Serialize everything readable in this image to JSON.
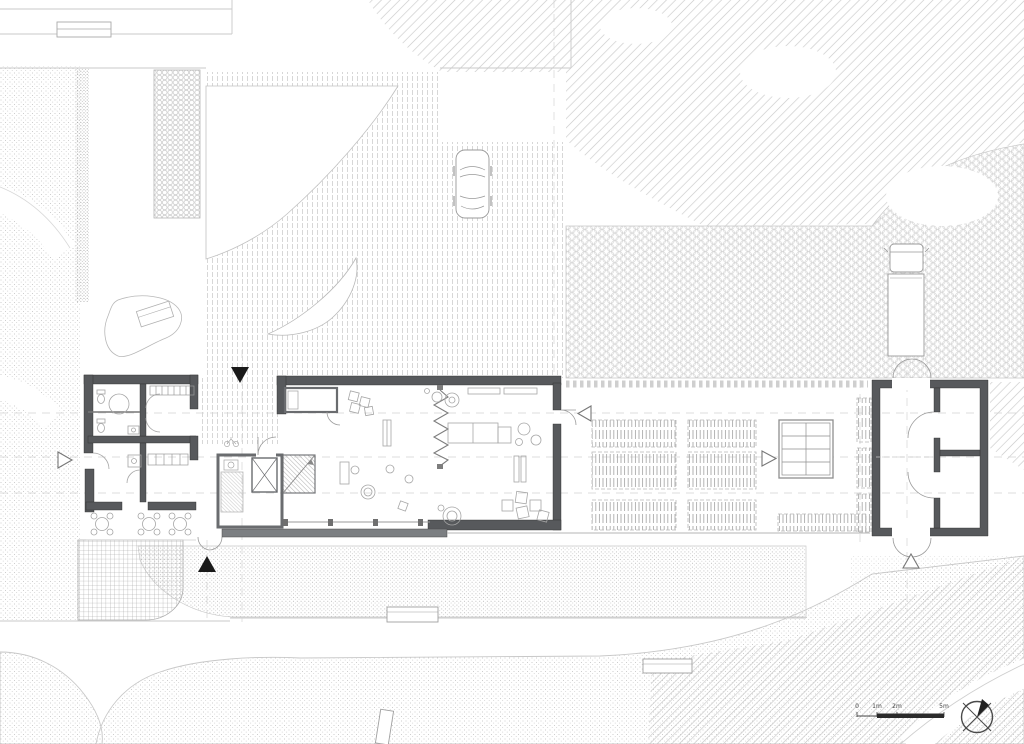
{
  "meta": {
    "drawing_type": "architectural ground-floor site plan",
    "background": "#ffffff"
  },
  "scale_bar": {
    "labels": [
      "0",
      "1m",
      "2m",
      "5m"
    ]
  },
  "symbols": {
    "north_arrow": "crossed-circle north symbol",
    "entrance_marker": "solid black triangle",
    "door_marker": "open white triangle"
  },
  "colors": {
    "ink_light": "#c8c8c8",
    "ink_mid": "#9a9a9a",
    "ink_dark": "#555555",
    "wall_fill": "#57595c",
    "terrace_band": "#7c7f82",
    "marker_black": "#1a1a1a"
  }
}
